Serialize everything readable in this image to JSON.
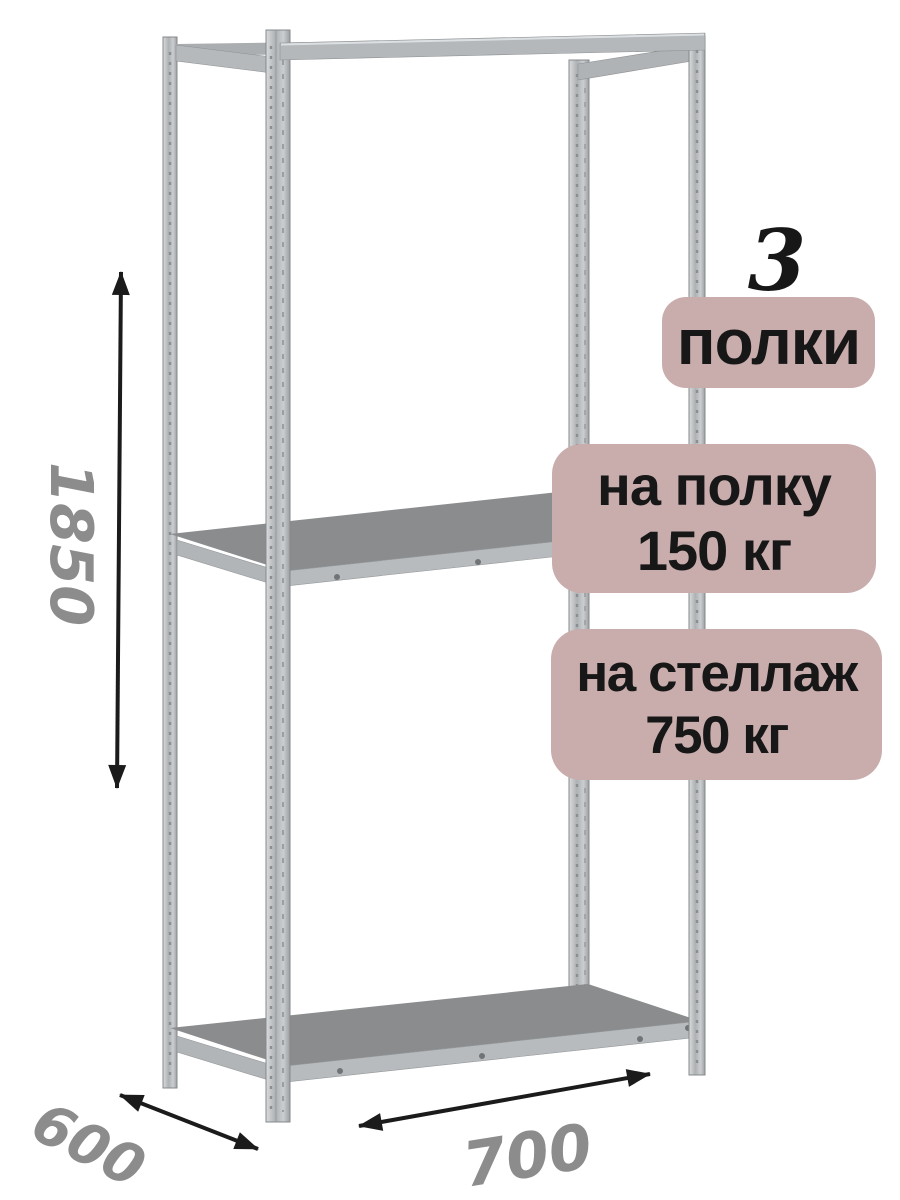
{
  "badges": {
    "count_number": "3",
    "count_label": "полки",
    "per_shelf_line1": "на полку",
    "per_shelf_line2": "150 кг",
    "per_rack_line1": "на стеллаж",
    "per_rack_line2": "750 кг"
  },
  "dimensions": {
    "height_mm": "1850",
    "depth_mm": "600",
    "width_mm": "700"
  },
  "illustration": {
    "subject": "metal-shelving-rack",
    "shelf_count": 3,
    "arrow_icons": [
      "height-double-arrow",
      "depth-double-arrow",
      "width-double-arrow"
    ]
  },
  "colors": {
    "badge_bg": "#c9acac",
    "text_dark": "#171717",
    "dimension_text": "#8c8c8c",
    "arrow": "#1b1b1b",
    "metal_light": "#c7cacc",
    "metal_beam": "#b5b8ba",
    "shelf_top": "#8a8c8e",
    "background": "#ffffff"
  }
}
